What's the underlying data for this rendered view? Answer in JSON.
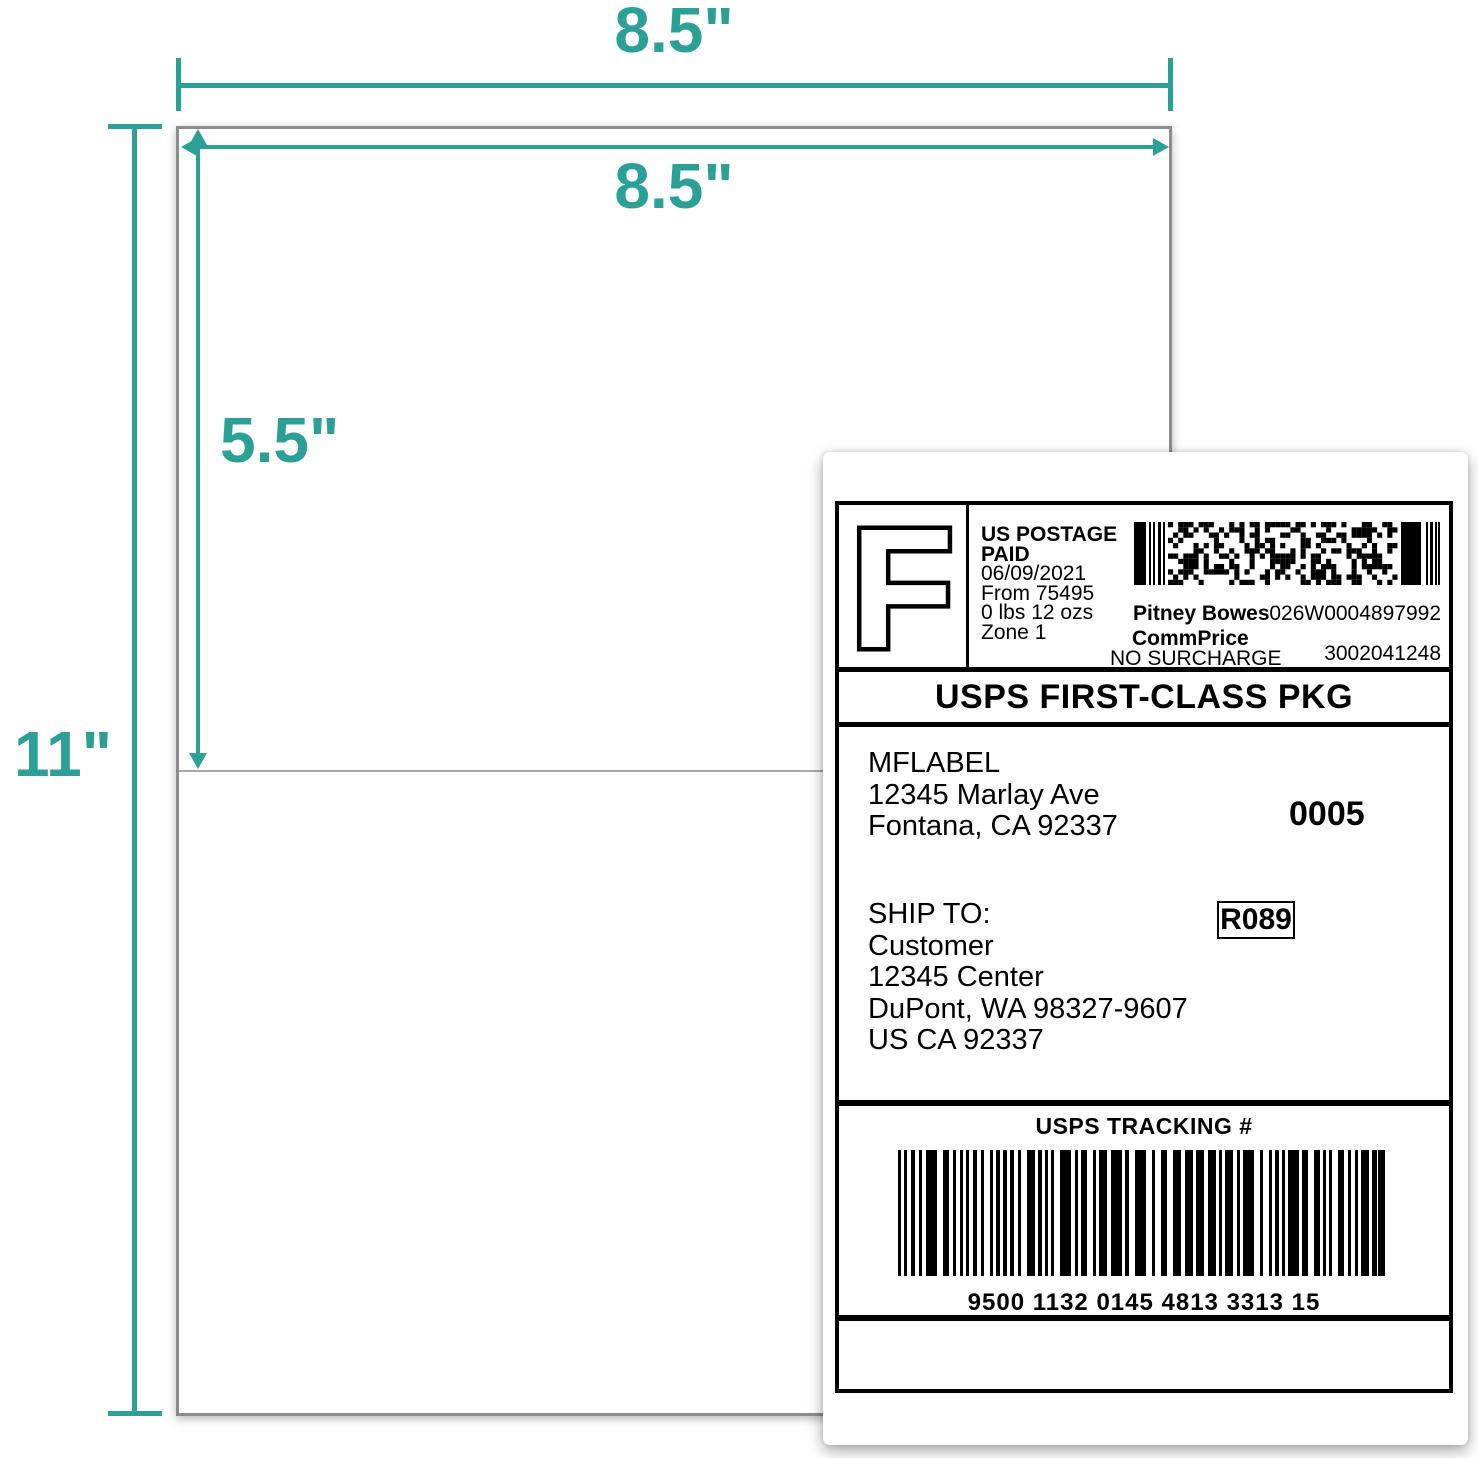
{
  "colors": {
    "accent_teal": "#2aa096",
    "sheet_border_gray": "#8c8c8c",
    "divider_gray": "#a9a9a9",
    "label_ink": "#000000"
  },
  "dimensions": {
    "top_width": "8.5\"",
    "inner_width": "8.5\"",
    "half_height": "5.5\"",
    "full_height": "11\""
  },
  "shipping_label": {
    "indicia": {
      "letter": "F",
      "postage_lines": [
        "US POSTAGE",
        "PAID",
        "06/09/2021",
        "From 75495",
        "0 lbs 12 ozs",
        "Zone 1"
      ],
      "carrier": "Pitney Bowes",
      "rate_tier": "CommPrice",
      "surcharge": "NO SURCHARGE",
      "meter_number": "026W0004897992",
      "serial_number": "3002041248"
    },
    "service_banner": "USPS FIRST-CLASS PKG",
    "from_address": {
      "name": "MFLABEL",
      "street": "12345 Marlay Ave",
      "city": "Fontana, CA 92337"
    },
    "batch_number": "0005",
    "ship_to_label": "SHIP TO:",
    "to_address": {
      "name": "Customer",
      "street": "12345 Center",
      "city": "DuPont, WA 98327-9607",
      "country": "US CA 92337"
    },
    "route_code": "R089",
    "tracking_header": "USPS TRACKING #",
    "tracking_number": "9500 1132 0145 4813 3313 15"
  }
}
